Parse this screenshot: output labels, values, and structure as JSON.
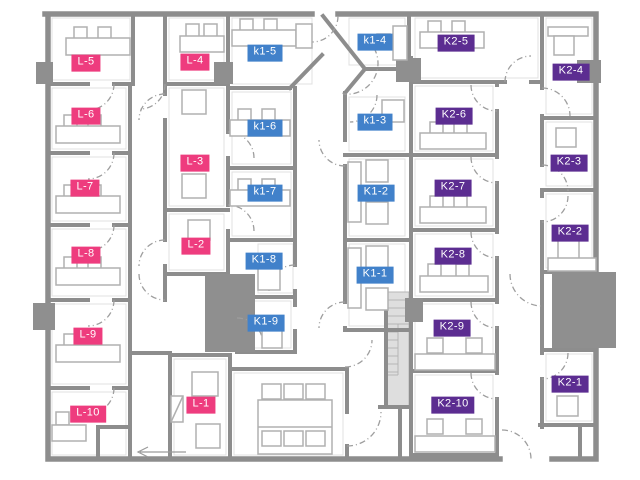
{
  "floorplan": {
    "canvas": {
      "width": 640,
      "height": 480
    },
    "groups": [
      {
        "id": "L",
        "color": "#ee3c7e"
      },
      {
        "id": "K1",
        "color": "#4181ca"
      },
      {
        "id": "K2",
        "color": "#5c2d91"
      }
    ],
    "rooms": [
      {
        "label": "L-1",
        "group": "L",
        "x": 201,
        "y": 405
      },
      {
        "label": "L-2",
        "group": "L",
        "x": 196,
        "y": 246
      },
      {
        "label": "L-3",
        "group": "L",
        "x": 195,
        "y": 163
      },
      {
        "label": "L-4",
        "group": "L",
        "x": 195,
        "y": 62
      },
      {
        "label": "L-5",
        "group": "L",
        "x": 86,
        "y": 63
      },
      {
        "label": "L-6",
        "group": "L",
        "x": 86,
        "y": 116
      },
      {
        "label": "L-7",
        "group": "L",
        "x": 85,
        "y": 188
      },
      {
        "label": "L-8",
        "group": "L",
        "x": 86,
        "y": 255
      },
      {
        "label": "L-9",
        "group": "L",
        "x": 88,
        "y": 336
      },
      {
        "label": "L-10",
        "group": "L",
        "x": 88,
        "y": 414
      },
      {
        "label": "K1-1",
        "group": "K1",
        "x": 375,
        "y": 275
      },
      {
        "label": "K1-2",
        "group": "K1",
        "x": 376,
        "y": 193
      },
      {
        "label": "k1-3",
        "group": "K1",
        "x": 375,
        "y": 122
      },
      {
        "label": "k1-4",
        "group": "K1",
        "x": 375,
        "y": 42
      },
      {
        "label": "k1-5",
        "group": "K1",
        "x": 265,
        "y": 53
      },
      {
        "label": "k1-6",
        "group": "K1",
        "x": 265,
        "y": 128
      },
      {
        "label": "k1-7",
        "group": "K1",
        "x": 265,
        "y": 193
      },
      {
        "label": "K1-8",
        "group": "K1",
        "x": 264,
        "y": 261
      },
      {
        "label": "K1-9",
        "group": "K1",
        "x": 266,
        "y": 323
      },
      {
        "label": "K2-1",
        "group": "K2",
        "x": 570,
        "y": 384
      },
      {
        "label": "K2-2",
        "group": "K2",
        "x": 570,
        "y": 233
      },
      {
        "label": "K2-3",
        "group": "K2",
        "x": 569,
        "y": 163
      },
      {
        "label": "K2-4",
        "group": "K2",
        "x": 571,
        "y": 72
      },
      {
        "label": "K2-5",
        "group": "K2",
        "x": 456,
        "y": 43
      },
      {
        "label": "K2-6",
        "group": "K2",
        "x": 454,
        "y": 116
      },
      {
        "label": "K2-7",
        "group": "K2",
        "x": 453,
        "y": 188
      },
      {
        "label": "K2-8",
        "group": "K2",
        "x": 453,
        "y": 256
      },
      {
        "label": "K2-9",
        "group": "K2",
        "x": 452,
        "y": 328
      },
      {
        "label": "K2-10",
        "group": "K2",
        "x": 453,
        "y": 405
      }
    ]
  }
}
